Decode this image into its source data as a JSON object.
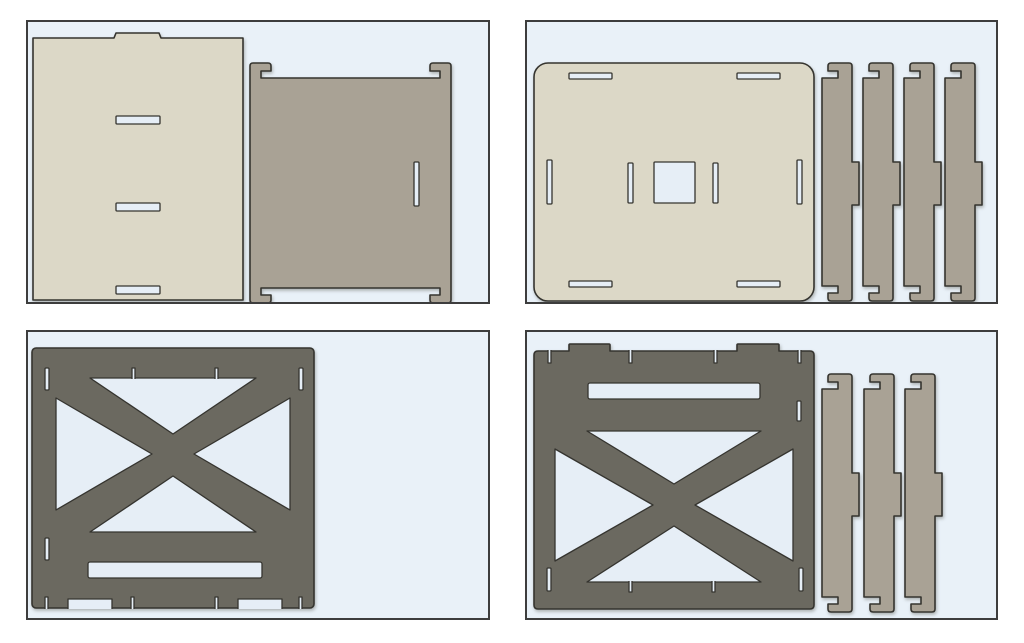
{
  "app": {
    "view": "flat-pattern-sheet-layout",
    "visible_text": ""
  },
  "colors": {
    "page_bg": "#ffffff",
    "panel_bg": "#e9f1f8",
    "panel_border": "#3d3d3d",
    "outline": "#35342f",
    "beige": "#dcd8c7",
    "taupe": "#a9a295",
    "dark": "#6b6960",
    "cut_fill": "#e6eef6"
  },
  "panels": [
    {
      "id": "sheet-1",
      "position": "top-left",
      "parts": [
        {
          "name": "flat-plate-with-tab-and-3-slots",
          "color_ref": "beige",
          "count": 1
        },
        {
          "name": "side-panel-with-4-corner-hooks",
          "color_ref": "taupe",
          "count": 1
        }
      ]
    },
    {
      "id": "sheet-2",
      "position": "top-right",
      "parts": [
        {
          "name": "base-plate-rounded-with-center-square-hole",
          "color_ref": "beige",
          "count": 1
        },
        {
          "name": "hooked-batten-strip",
          "color_ref": "taupe",
          "count": 4
        }
      ]
    },
    {
      "id": "sheet-3",
      "position": "bottom-left",
      "parts": [
        {
          "name": "x-braced-panel-bottom-notched",
          "color_ref": "dark",
          "count": 1
        }
      ]
    },
    {
      "id": "sheet-4",
      "position": "bottom-right",
      "parts": [
        {
          "name": "x-braced-panel-top-tabbed",
          "color_ref": "dark",
          "count": 1
        },
        {
          "name": "hooked-batten-strip",
          "color_ref": "taupe",
          "count": 3
        }
      ]
    }
  ]
}
